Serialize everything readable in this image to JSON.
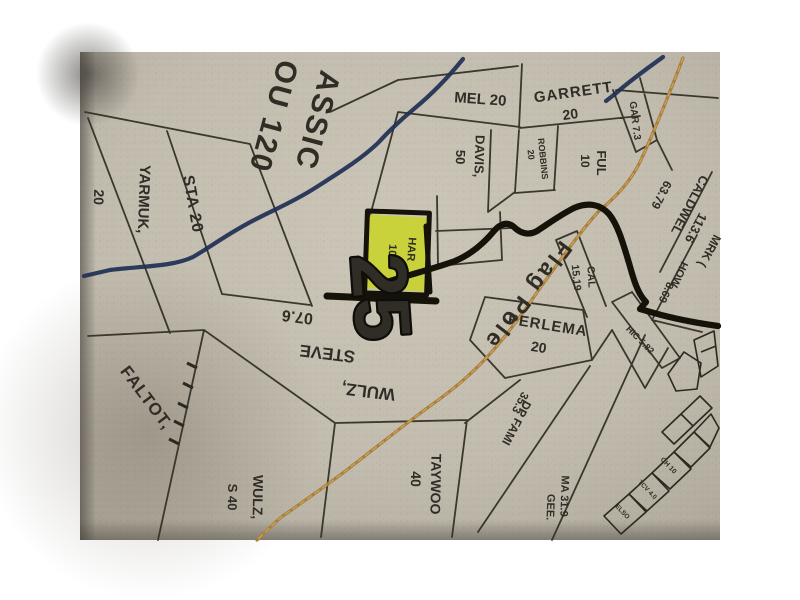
{
  "page": {
    "background": "#ffffff",
    "type": "photographed plat map"
  },
  "colors": {
    "paper": "#c2bcaf",
    "boundary_line": "#3a372d",
    "river": "#1f2f55",
    "road": "#a87e3c",
    "road_dash": "#c9a35f",
    "highway": "#151209",
    "highlight": "#c8d41e",
    "highlight_text": "#44430f",
    "road_name_red": "#86242e",
    "section_number_fill": "#ece8dc",
    "section_number_stroke": "#0e0d0a"
  },
  "map": {
    "section_number": "25",
    "road_name": "Flag Pole",
    "highlighted_parcel": {
      "owner": "HAR",
      "acres": "10"
    },
    "labels": {
      "mel": "MEL 20",
      "garrett_name": "GARRETT",
      "garrett_acres": "20",
      "davis_name": "DAVIS,",
      "davis_acres": "50",
      "robbins_name": "ROBBINS",
      "robbins_acres": "20",
      "ful_name": "FUL",
      "ful_acres": "10",
      "gar": "GAR 7.3",
      "caldwel_name": "CALDWEL",
      "caldwel_acres": "63.79",
      "mrk_acres": "113.6",
      "mrk_name": "MRK (",
      "how_name": "HOW",
      "how_acres": "8.69",
      "hic": "HIC 5.82",
      "cal_name": "CAL",
      "cal_acres": "15.19",
      "flag_pole": "Flag Pole",
      "perlema_name": "PERLEMA",
      "perlema_acres": "20",
      "dp_name": "DP FAMI",
      "dp_acres": "35.3",
      "gee_name": "GEE.",
      "gee_acres": "MA 31.9",
      "taywoo_name": "TAYWOO",
      "taywoo_acres": "40",
      "wulzs_name": "WULZ,",
      "wulzs_acres": "S 40",
      "faltot": "FALTOT,",
      "wulz_steve_line1": "WULZ,",
      "wulz_steve_line2": "STEVE",
      "wulz_steve_line3": "07.6",
      "har_name": "HAR",
      "har_acres": "10",
      "classic_line1": "ASSIC",
      "classic_line2": "OU 120",
      "sta": "STA 20",
      "yarmuk_name": "YARMUK,",
      "yarmuk_acres": "20",
      "big25": "25",
      "lot_elso": "ELSO",
      "lot_tcv": "TCV 4.0",
      "lot_ch": "CH 10"
    }
  }
}
